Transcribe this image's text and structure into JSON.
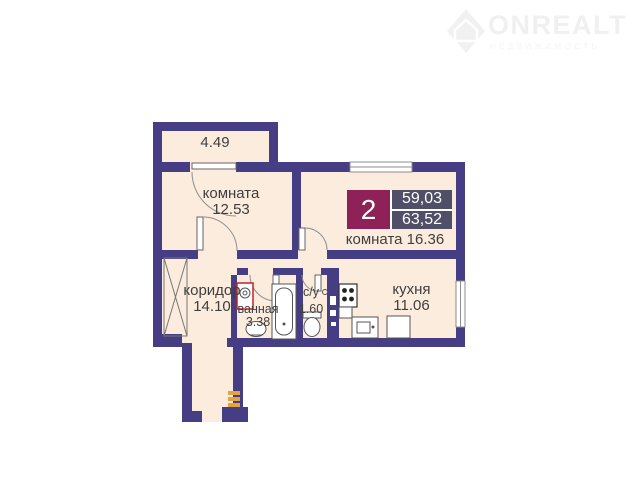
{
  "logo": {
    "brand": "ONREALT",
    "tagline": "НЕДВИЖИМОСТЬ",
    "icon": "house-diamond-icon"
  },
  "plan": {
    "badge": {
      "room_count": "2",
      "value_top": "59,03",
      "value_bottom": "63,52"
    },
    "rooms": {
      "balcony": {
        "area": "4.49"
      },
      "room1": {
        "name": "комната",
        "area": "12.53"
      },
      "room2": {
        "name": "комната",
        "area": "16.36"
      },
      "corridor": {
        "name": "коридор",
        "area": "14.10"
      },
      "bathroom": {
        "name": "ванная",
        "area": "3.38"
      },
      "wc": {
        "name": "с/у",
        "area": "1.60"
      },
      "kitchen": {
        "name": "кухня",
        "area": "11.06"
      }
    }
  },
  "colors": {
    "wall": "#453e85",
    "floor": "#fcecdd",
    "badge_left": "#8e2157",
    "badge_right": "#4f4f68",
    "accent_red": "#c42127",
    "accent_yellow": "#e6a43c",
    "label_text": "#3f3f3f",
    "logo": "#f0f0f0"
  }
}
